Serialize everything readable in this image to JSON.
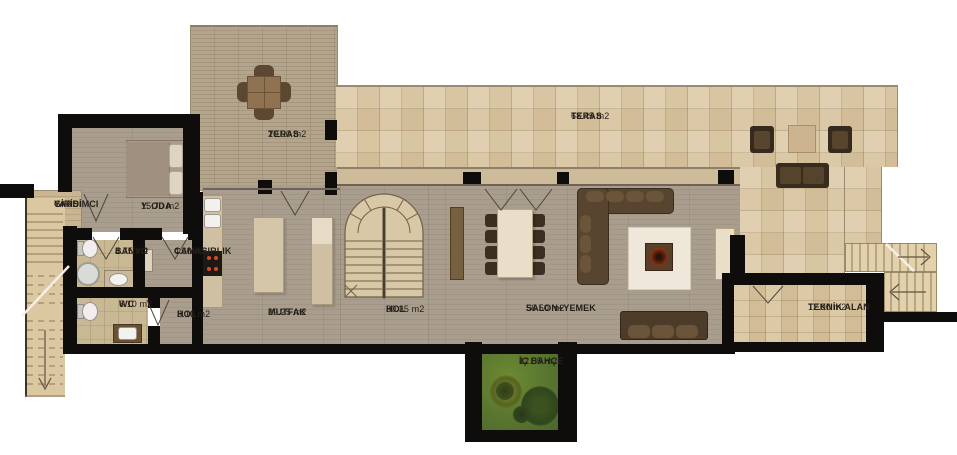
{
  "plan": {
    "rooms": {
      "yardimci_girisi": {
        "name": "YARDIMCI",
        "name2": "GİRİSİ"
      },
      "y_oda": {
        "name": "Y. ODA",
        "area": "15.70 m2"
      },
      "banyo": {
        "name": "BANYO",
        "area": "4.75 m2"
      },
      "camasirlik": {
        "name": "CAMASIRLIK",
        "area": "4.60 m2"
      },
      "wc": {
        "name": "WC",
        "area": "6.10 m2"
      },
      "hol_kucuk": {
        "name": "HOL",
        "area": "3.10 m2"
      },
      "mutfak": {
        "name": "MUTFAK",
        "area": "29.25 m2"
      },
      "teras_on": {
        "name": "TERAS",
        "area": "20.90 m2"
      },
      "hol_buyuk": {
        "name": "HOL",
        "area": "30.35 m2"
      },
      "salon_yemek": {
        "name": "SALON+YEMEK",
        "area": "56.50 m2"
      },
      "teras_buyuk": {
        "name": "TERAS",
        "area": "68.45 m2"
      },
      "teknik_alan": {
        "name": "TEKNİK ALAN",
        "area": "12.90 m2"
      },
      "ic_bahce": {
        "name": "İÇ BAHÇE",
        "area": "12.05 m2"
      }
    },
    "palette": {
      "wall": "#0f0d0b",
      "interior_floor": "#a69a8a",
      "wood_deck": "#b3a58c",
      "tile_terrace": "#dccaa7",
      "stair_tan": "#dbc7a0",
      "garden_green": "#5c7a31",
      "furniture_dark": "#3c2f21",
      "sofa_brown": "#57452f",
      "label_text": "#241f18"
    }
  }
}
